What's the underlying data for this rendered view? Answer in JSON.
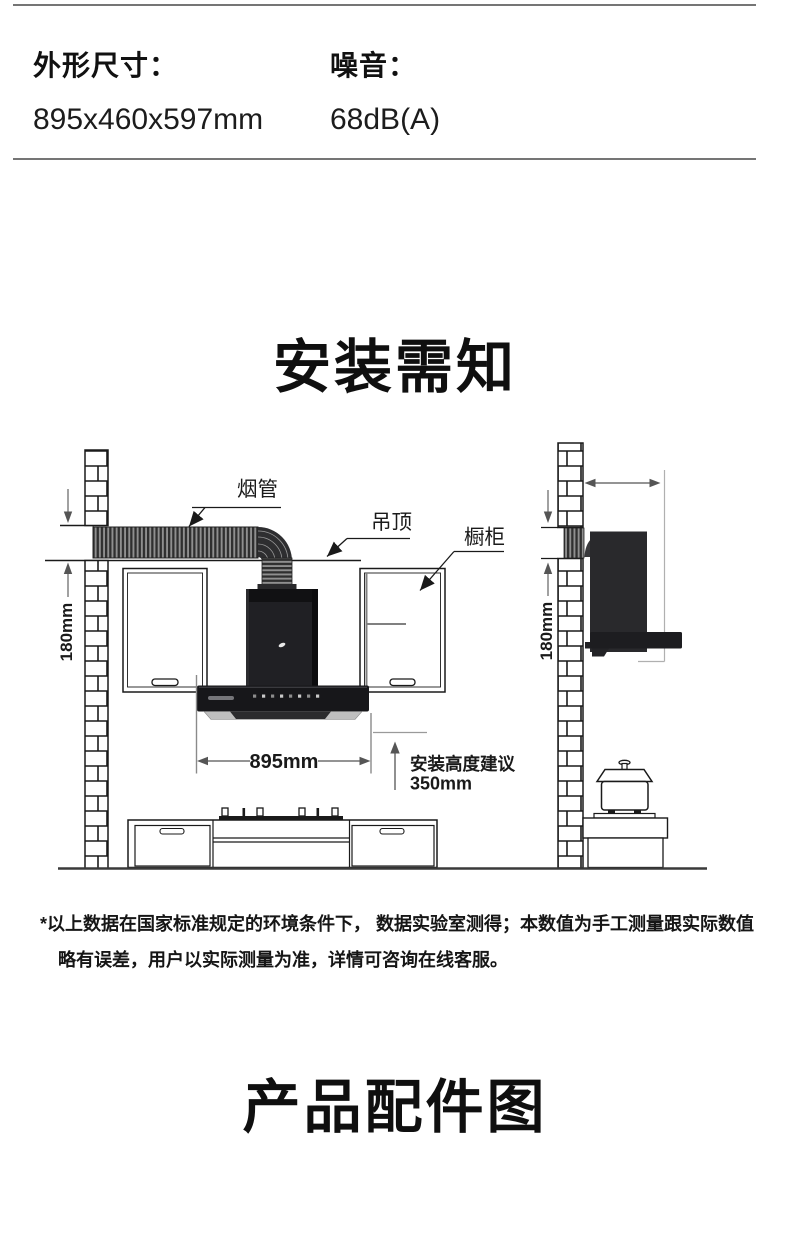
{
  "specs": {
    "items": [
      {
        "label": "外形尺寸：",
        "value": "895x460x597mm"
      },
      {
        "label": "噪音：",
        "value": "68dB(A)"
      }
    ]
  },
  "install": {
    "title": "安装需知",
    "labels": {
      "duct": "烟管",
      "ceiling": "吊顶",
      "cabinet": "橱柜",
      "gap_front": "180mm",
      "gap_side": "180mm",
      "hood_width": "895mm",
      "height_note_title": "安装高度建议",
      "height_note_value": "350mm"
    },
    "footnote_line1": "*以上数据在国家标准规定的环境条件下， 数据实验室测得；本数值为手工测量跟实际数值",
    "footnote_line2": "略有误差，用户以实际测量为准，详情可咨询在线客服。"
  },
  "accessories": {
    "title": "产品配件图"
  },
  "colors": {
    "divider": "#757575",
    "line_art": "#1a1a1a",
    "dimension_gray": "#555555",
    "hood_black": "#1b1b1d",
    "duct_stripe_dark": "#2f2f2f",
    "duct_stripe_light": "#8f8f8f"
  }
}
